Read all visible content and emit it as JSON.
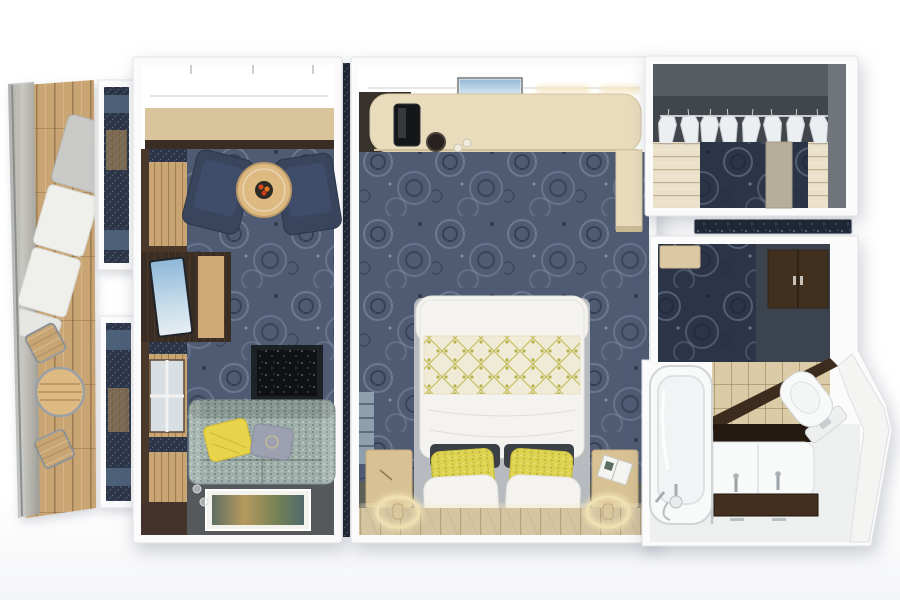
{
  "scene": {
    "description": "3D top-down cutaway floor plan render of a cruise-ship suite",
    "view": "top-down 3D render, no visible text",
    "rooms_count": 6
  },
  "rooms": {
    "balcony": {
      "name": "balcony",
      "items": [
        "glass-balustrade",
        "teak-deck",
        "sun-lounger",
        "bistro-table",
        "deck-chairs"
      ]
    },
    "living_room": {
      "name": "living-room",
      "items": [
        "window-wall",
        "armchairs",
        "round-coffee-table",
        "fruit-bowl",
        "tv-cabinet",
        "television",
        "fireplace",
        "sofa",
        "yellow-pillow",
        "gray-pillow",
        "floor-artwork",
        "wine-glasses"
      ]
    },
    "bedroom": {
      "name": "bedroom",
      "items": [
        "vanity-desk",
        "coffee-machine",
        "wall-tv",
        "king-bed",
        "floral-throw",
        "sequin-pillows",
        "white-pillows",
        "nightstands",
        "sconce-lamps",
        "headboard-wall",
        "towel-ladder"
      ]
    },
    "closet": {
      "name": "walk-in-closet",
      "items": [
        "hanging-rail",
        "garments",
        "wardrobe-panels",
        "carpet-runner",
        "column"
      ]
    },
    "entry_hall": {
      "name": "entry-hall",
      "items": [
        "bench",
        "wardrobe-cabinet",
        "carpet",
        "door-mat"
      ]
    },
    "bathroom": {
      "name": "bathroom",
      "items": [
        "bathtub",
        "shower-mixer",
        "tiled-wall",
        "double-vanity",
        "faucets",
        "dark-counter",
        "toilet",
        "angled-hull-wall",
        "glass-screen"
      ]
    }
  },
  "palette": {
    "background": "#ffffff",
    "wall": "#fbfbfb",
    "carpet_slate": "#4f5b73",
    "carpet_navy": "#2c3548",
    "deck_wood": "#c9a574",
    "glass": "#b4b6b3",
    "lounger_white": "#efefec",
    "living_floor_gray": "#56595c",
    "counter_tan": "#d9c49c",
    "dark_wood": "#3a2d23",
    "armchair_navy": "#39455c",
    "table_wood": "#ddba82",
    "sofa_fabric": "#9fb0aa",
    "pillow_yellow": "#e8d44a",
    "pillow_gray": "#9da0b0",
    "fireplace": "#101113",
    "desk_tan": "#e9dcbd",
    "bed_white": "#f4f3ef",
    "runner_cream": "#f0ebd6",
    "sequin_yellow": "#ded34f",
    "headboard_dark": "#3b4046",
    "nightstand_tan": "#d8c294",
    "wood_wall": "#d5c4a1",
    "glow": "#f6e8c4",
    "closet_wall": "#585d63",
    "closet_recess": "#41464c",
    "closet_floor": "#ebe1cb",
    "garment_white": "#eceff1",
    "hall_slate": "#3b444e",
    "wardrobe_wood": "#42301f",
    "bench_tan": "#dcc9a4",
    "tile": "#dbcba6",
    "vanity_counter": "#432f20",
    "fixture_white": "#f8f9f9",
    "divider_navy": "#1e2532"
  }
}
